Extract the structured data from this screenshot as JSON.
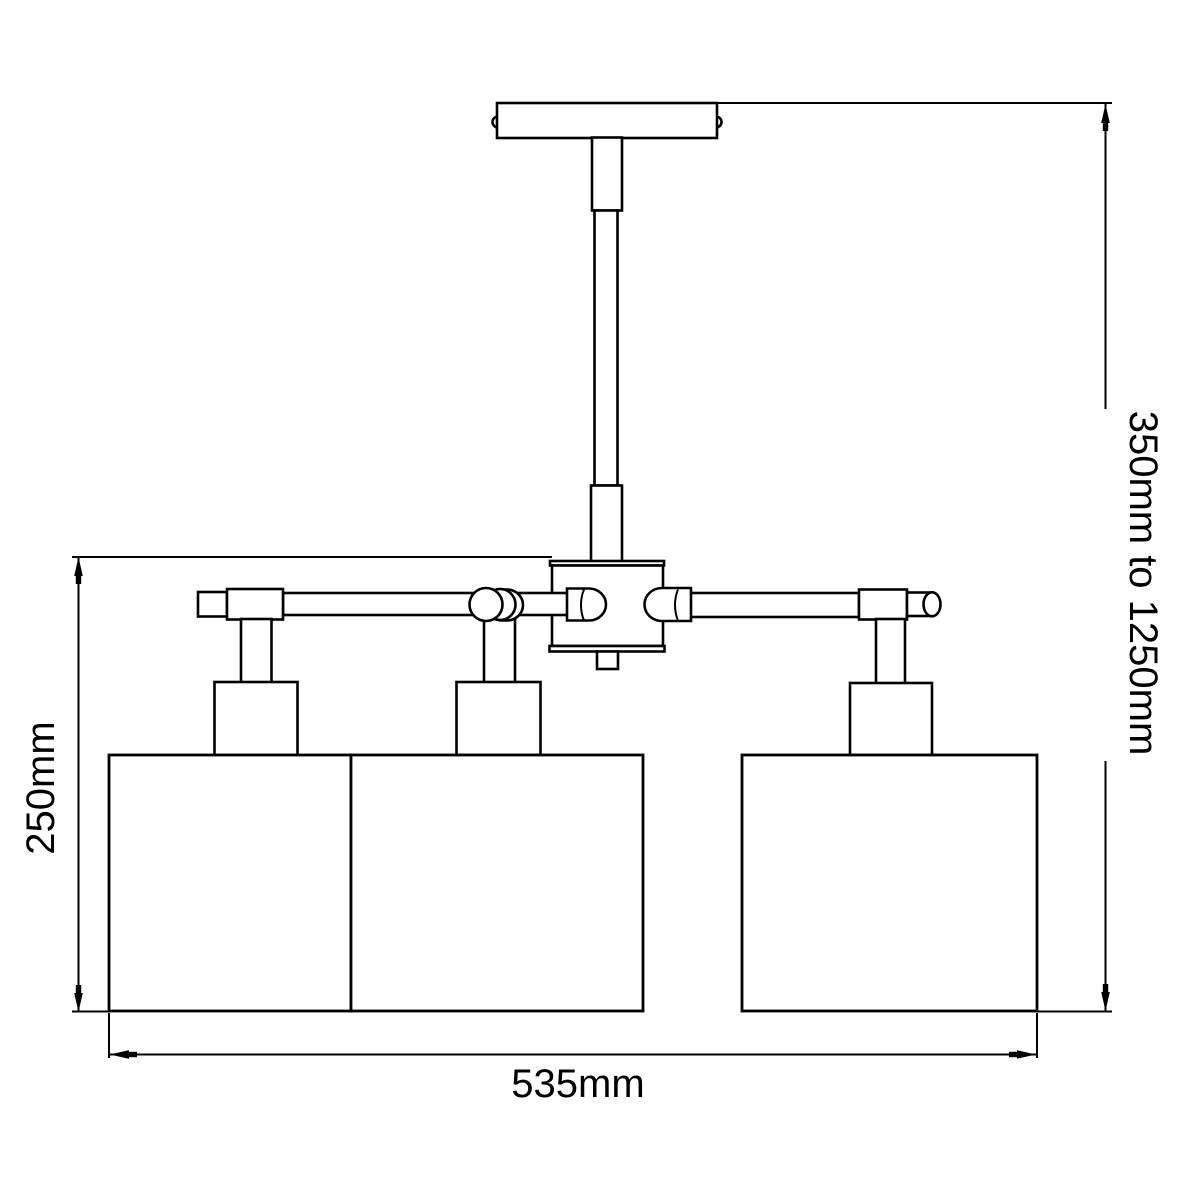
{
  "diagram": {
    "description": "Technical dimension drawing of a three-shade semi-flush ceiling light",
    "background_color": "#ffffff",
    "line_color": "#000000",
    "labels": {
      "height_range": "350mm to 1250mm",
      "body_height": "250mm",
      "width": "535mm"
    }
  }
}
